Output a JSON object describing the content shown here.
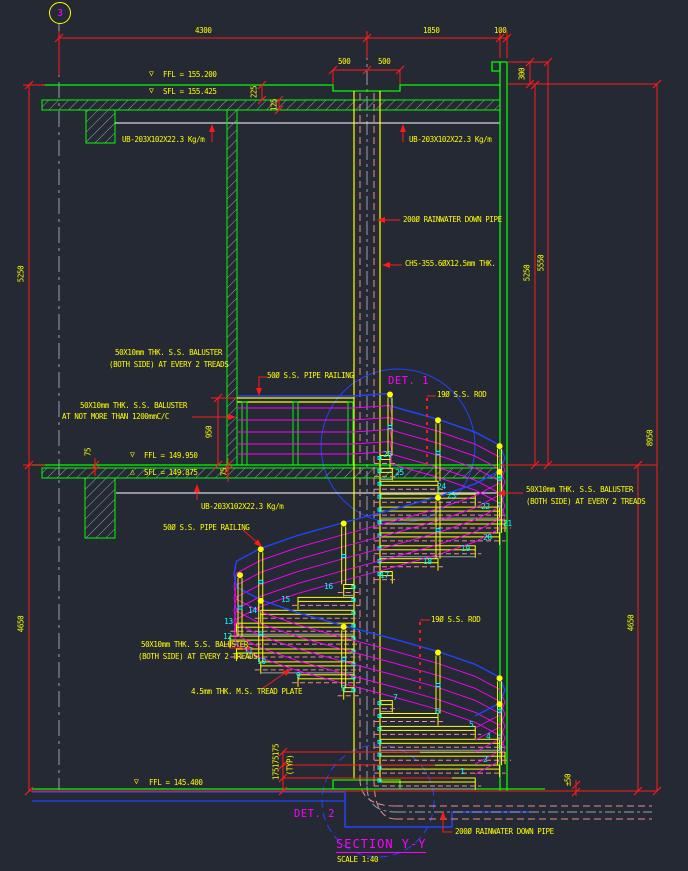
{
  "grid": {
    "bubble": "3"
  },
  "title_block": {
    "detail_1": "DET. 1",
    "detail_2": "DET. 2",
    "section_title": "SECTION Y-Y",
    "scale": "SCALE 1:40"
  },
  "levels": {
    "down_symbol": "▽",
    "up_symbol": "△",
    "roof_ffl": "FFL = 155.200",
    "roof_sfl": "SFL = 155.425",
    "mid_ffl": "FFL = 149.950",
    "mid_sfl": "SFL = 149.875",
    "ground_ffl": "FFL = 145.400"
  },
  "dimensions": {
    "span_grid_to_pipe": "4300",
    "span_pipe_to_wall": "1850",
    "wall_thickness": "100",
    "curb_left": "500",
    "curb_right": "500",
    "parapet_height": "300",
    "roof_finish": "225",
    "roof_slab": "125",
    "left_upper": "5250",
    "left_lower": "4650",
    "right_floor_to_floor": "5250",
    "right_parapet_to_floor": "5550",
    "right_overall": "8950",
    "right_lower": "4650",
    "balustrade_height": "950",
    "mid_finish_left": "75",
    "mid_finish_right": "75",
    "riser_a": "175",
    "riser_b": "175",
    "riser_c": "175",
    "riser_note": "(TYP)",
    "ground_tolerance": "±50"
  },
  "annotations": {
    "ub_roof_left": "UB-203X102X22.3 Kg/m",
    "ub_roof_right": "UB-203X102X22.3 Kg/m",
    "ub_mid_floor": "UB-203X102X22.3 Kg/m",
    "rainwater_pipe_top": "200Ø RAINWATER DOWN PIPE",
    "rainwater_pipe_bottom": "200Ø RAINWATER DOWN PIPE",
    "chs_column": "CHS-355.6ØX12.5mm THK.",
    "baluster_top_line1": "50X10mm THK. S.S. BALUSTER",
    "baluster_top_line2": "(BOTH SIDE) AT EVERY 2 TREADS",
    "baluster_spacing_line1": "50X10mm THK. S.S. BALUSTER",
    "baluster_spacing_line2": "AT NOT MORE THAN 1200mmC/C",
    "baluster_right_line1": "50X10mm THK. S.S. BALUSTER",
    "baluster_right_line2": "(BOTH SIDE) AT EVERY 2 TREADS",
    "baluster_lower_line1": "50X10mm THK. S.S. BALUSTER",
    "baluster_lower_line2": "(BOTH SIDE) AT EVERY 2 TREADS",
    "pipe_railing_top": "50Ø S.S. PIPE RAILING",
    "pipe_railing_mid": "50Ø S.S. PIPE RAILING",
    "rod_upper": "19Ø S.S. ROD",
    "rod_lower": "19Ø S.S. ROD",
    "tread_plate": "4.5mm THK. M.S. TREAD PLATE"
  },
  "treads": {
    "numbers": [
      "1",
      "2",
      "3",
      "4",
      "5",
      "6",
      "7",
      "8",
      "9",
      "10",
      "11",
      "12",
      "13",
      "14",
      "15",
      "16",
      "17",
      "18",
      "19",
      "20",
      "21",
      "22",
      "23",
      "24",
      "25",
      "26"
    ]
  },
  "colors": {
    "background": "#242933",
    "line_green": "#00ff00",
    "line_yellow": "#ffff00",
    "line_red": "#ff1a1a",
    "line_magenta": "#ff00ff",
    "line_cyan": "#00ffff",
    "line_blue": "#2244ff",
    "line_salmon": "#f08c8c",
    "line_gray": "#9aa0a8",
    "line_white": "#ffffff"
  }
}
